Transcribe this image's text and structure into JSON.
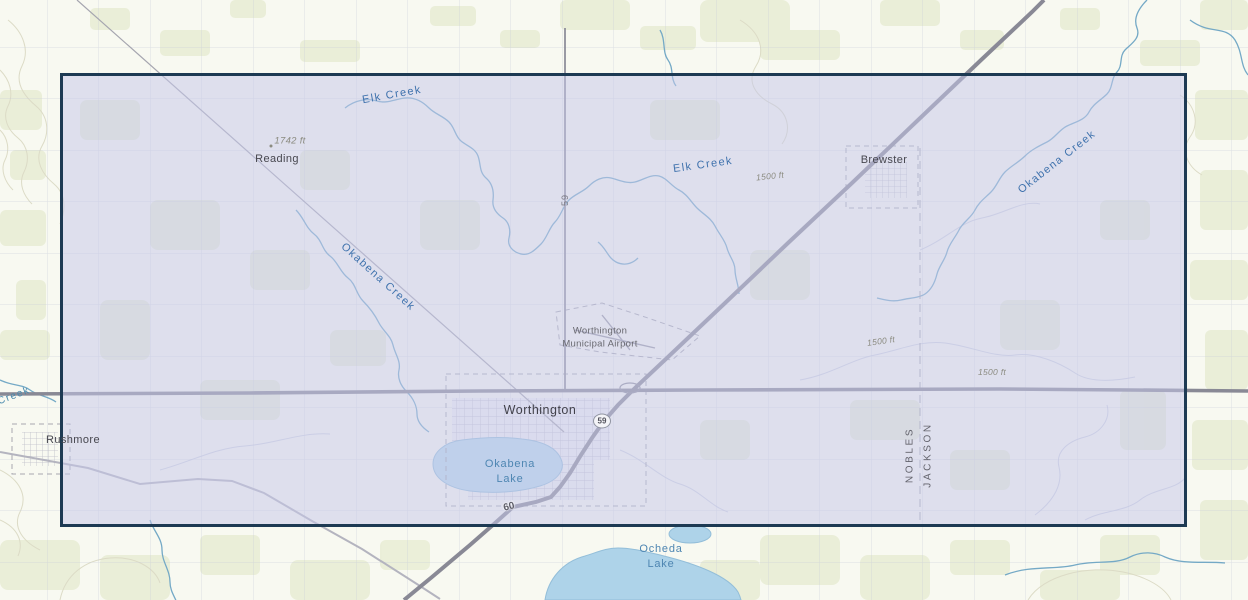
{
  "map_type": "topographic basemap with rectangular extent selection",
  "colors": {
    "map_background": "#f8f9f1",
    "selection_fill": "#c6c8e9",
    "selection_border": "#1d3a53",
    "water_fill": "#b5d7ea",
    "creek_line": "#74a9c6",
    "creek_label": "#3f72ad",
    "highway": "#898995",
    "vegetation_patch": "#e9edd6"
  },
  "selection": {
    "left_px": 60,
    "top_px": 73,
    "width_px": 1127,
    "height_px": 454
  },
  "places": {
    "reading": "Reading",
    "brewster": "Brewster",
    "worthington": "Worthington",
    "rushmore": "Rushmore",
    "airport_line1": "Worthington",
    "airport_line2": "Municipal Airport"
  },
  "waters": {
    "elk_creek_nw": "Elk Creek",
    "elk_creek_central": "Elk Creek",
    "okabena_creek_ne": "Okabena Creek",
    "okabena_creek_west": "Okabena Creek",
    "west_edge_creek": "Creek",
    "okabena_lake_line1": "Okabena",
    "okabena_lake_line2": "Lake",
    "ocheda_lake_line1": "Ocheda",
    "ocheda_lake_line2": "Lake"
  },
  "elevations": {
    "spot_1742": "1742 ft",
    "contour_1500_a": "1500 ft",
    "contour_1500_b": "1500 ft",
    "contour_1500_c": "1500 ft"
  },
  "routes": {
    "hwy_59_shield": "59",
    "hwy_59_north": "59",
    "hwy_60": "60"
  },
  "counties": {
    "nobles": "NOBLES",
    "jackson": "JACKSON"
  }
}
